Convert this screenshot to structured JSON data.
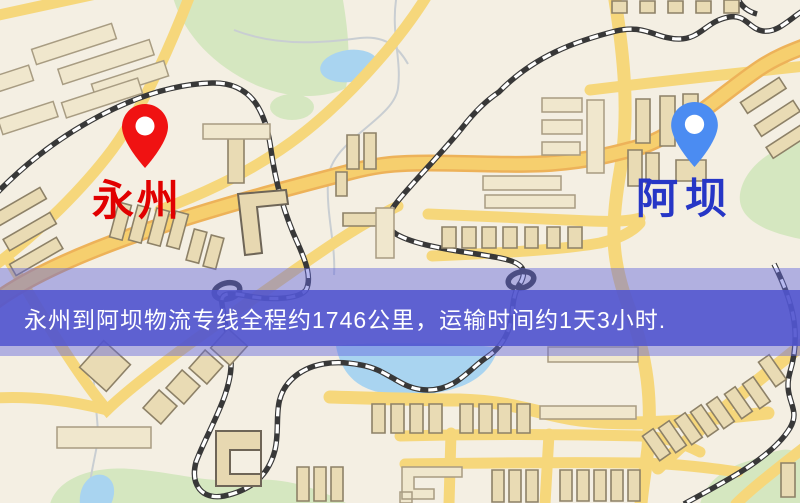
{
  "banner": {
    "text": "永州到阿坝物流专线全程约1746公里，运输时间约1天3小时.",
    "background_color": "#5054ce",
    "text_color": "#ffffff"
  },
  "route": {
    "origin": "永州",
    "destination": "阿坝",
    "service": "物流专线",
    "distance_km": "1746",
    "duration": "1天3小时"
  },
  "markers": {
    "origin": {
      "label": "永州",
      "pin_color": "#f01212",
      "label_color": "#e10000"
    },
    "destination": {
      "label": "阿坝",
      "pin_color": "#4b8cf2",
      "label_color": "#2636c6"
    }
  },
  "map_colors": {
    "background": "#f4efe3",
    "road": "#f6d77b",
    "railway": "#383838",
    "water": "#a9d4f0",
    "park": "#d5e7c0",
    "building": "#e9dbb4"
  }
}
